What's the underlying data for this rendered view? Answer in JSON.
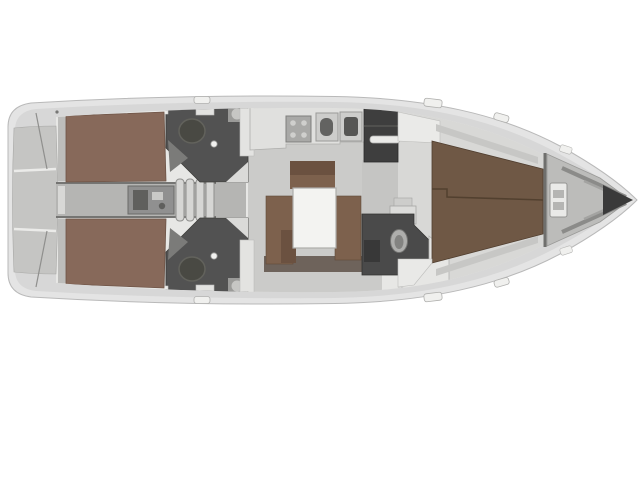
{
  "meta": {
    "title": "Top-down interior layout plan of a sailing yacht (bow pointing right)",
    "canvas_width": "640",
    "canvas_height": "480"
  },
  "colors": {
    "page_bg": "#ffffff",
    "hull_edge": "#e4e4e4",
    "outline": "#b9b9b9",
    "deck": "#d7d7d7",
    "interior": "#e7e7e5",
    "room_floor": "#d5d5d3",
    "salon_floor": "#cbcbc9",
    "passage_floor": "#c5c5c3",
    "fwd_floor": "#d8d8d6",
    "corridor": "#b5b5b3",
    "stern_locker": "#c5c5c3",
    "berth_aft": "#87695a",
    "berth_fwd": "#6f5845",
    "settee": "#7d614d",
    "settee_dark": "#6b5140",
    "plinth": "#6e635b",
    "table": "#f3f3f1",
    "head_dark": "#525252",
    "head_fwd_dark": "#4a4a4a",
    "wardrobe_dark": "#3e3e3e",
    "fixture_white": "#eaeae8",
    "counter": "#e0e0de",
    "appliance": "#a9a9a7",
    "sink_unit": "#cdcdcb",
    "sink_bowl": "#636361",
    "steps": "#d6d6d4",
    "engine": "#909090",
    "engine_dark": "#5f5f5d",
    "locker": "#bcbcba",
    "bow_tip": "#3a3a3a",
    "shelf_gray": "#c7c7c5",
    "wall": "#757573",
    "toilet_dark": "#494943",
    "toilet_light": "#aeaeac"
  },
  "regions": {
    "stern_locker": "stern-lazarette",
    "aft_cabin_port": "aft-double-cabin-port",
    "aft_cabin_starboard": "aft-double-cabin-starboard",
    "aft_head_port": "aft-head-wc-port",
    "aft_head_starboard": "aft-head-wc-starboard",
    "engine_room": "engine-compartment",
    "companionway": "companionway-steps",
    "galley": "galley-stove-and-sinks",
    "salon": "salon-settee-and-table",
    "wardrobe": "wardrobe-shower-locker",
    "forward_head": "forward-head-wc",
    "forward_cabin": "forward-owners-cabin",
    "anchor_locker": "bow-anchor-locker"
  }
}
